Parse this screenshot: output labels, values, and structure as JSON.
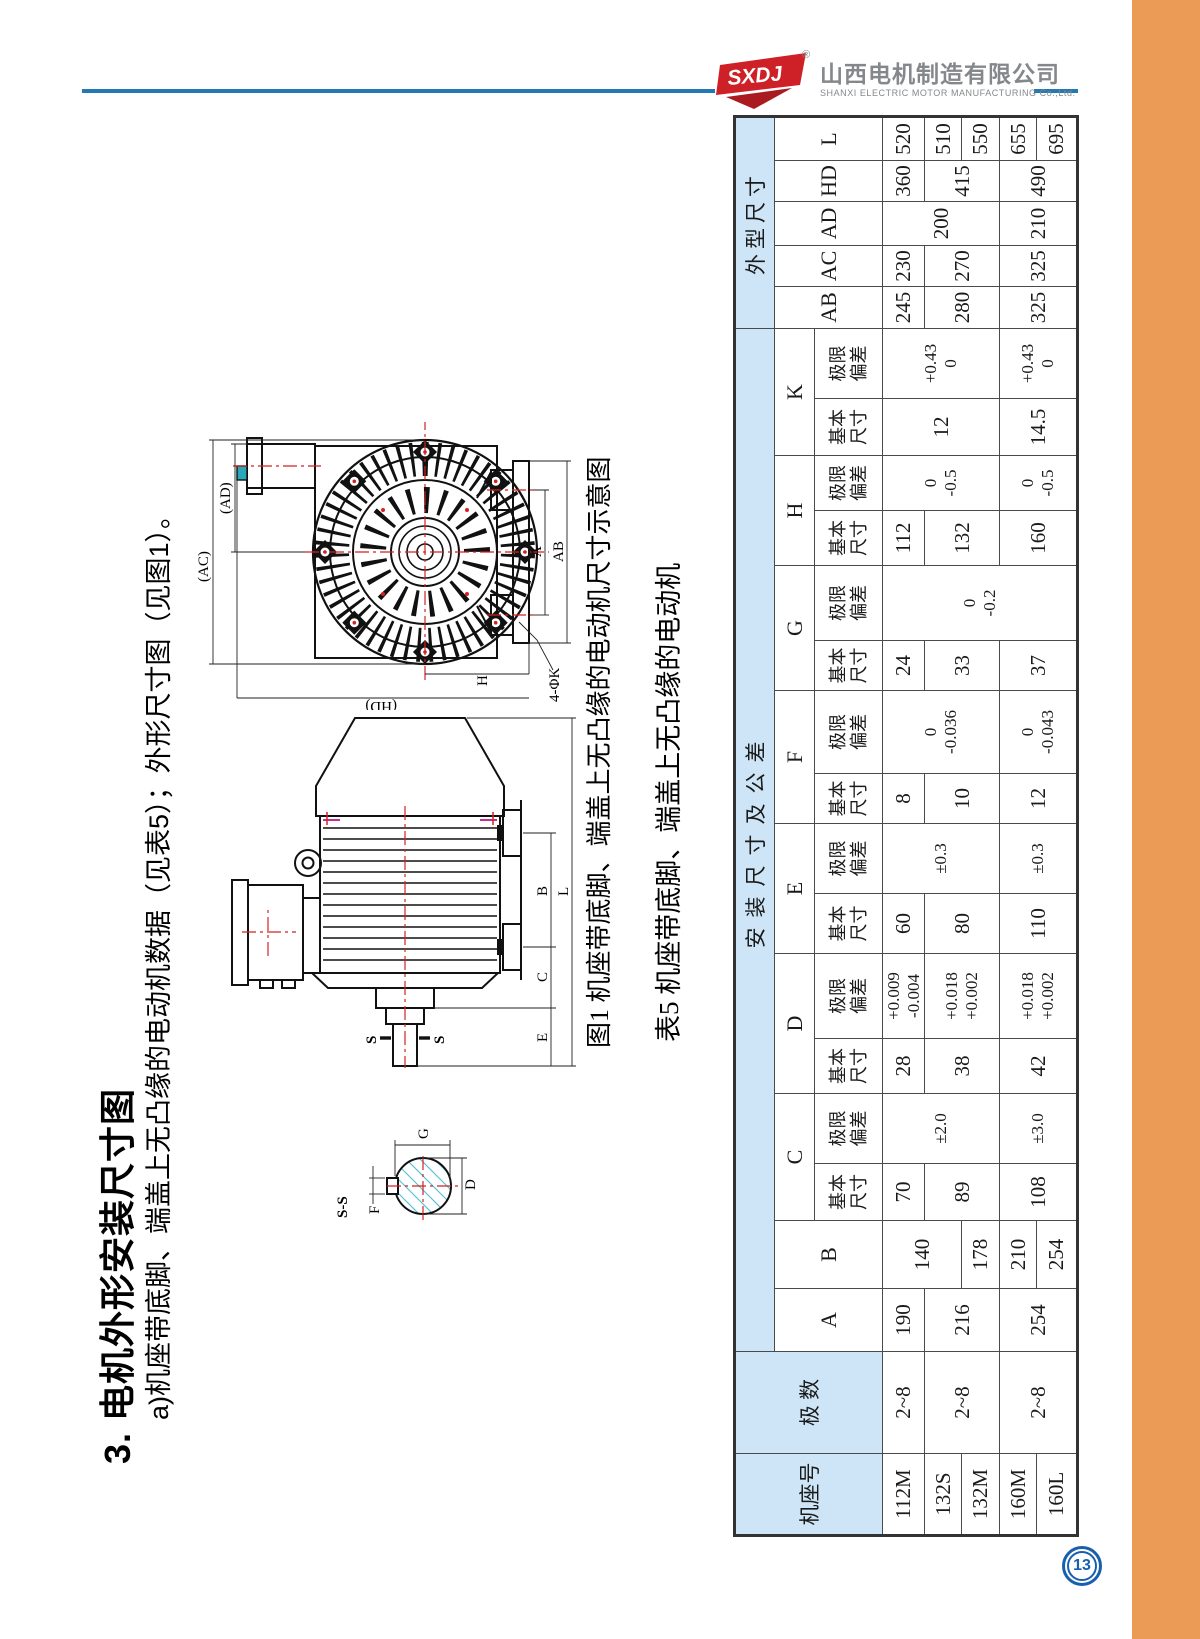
{
  "page": {
    "number": "13"
  },
  "colors": {
    "orange": "#EB9B55",
    "blue_line": "#2478B4",
    "table_header_bg": "#CDE5F6",
    "logo_red": "#CE2127",
    "logo_gray": "#85888B",
    "page_circle_blue": "#1860AE"
  },
  "header": {
    "logo_abbr": "SXDJ",
    "registered": "®",
    "company_cn": "山西电机制造有限公司",
    "company_en": "SHANXI ELECTRIC MOTOR MANUFACTURING Co.,Ltd."
  },
  "content": {
    "title": "3. 电机外形安装尺寸图",
    "subtitle": "a)机座带底脚、端盖上无凸缘的电动机数据（见表5）；外形尺寸图（见图1）。",
    "figure_caption": "图1 机座带底脚、端盖上无凸缘的电动机尺寸示意图",
    "table_caption": "表5 机座带底脚、端盖上无凸缘的电动机"
  },
  "figure": {
    "end_view": {
      "ac": "(AC)",
      "ad": "(AD)",
      "a": "A",
      "ab": "AB",
      "h": "H",
      "hd": "(HD)",
      "k4": "4-ΦK"
    },
    "side_view": {
      "s_top": "S",
      "s_bottom": "S",
      "e": "E",
      "c": "C",
      "b": "B",
      "l": "L"
    },
    "section_view": {
      "title": "S-S",
      "f": "F",
      "g": "G",
      "d": "D"
    }
  },
  "table": {
    "frame_label": "机座号",
    "poles_label": "极 数",
    "mount_group": "安装尺寸及公差",
    "outline_group": "外型尺寸",
    "sub_basic": [
      "基本",
      "尺寸"
    ],
    "sub_dev": [
      "极限",
      "偏差"
    ],
    "letters": [
      "A",
      "B",
      "C",
      "D",
      "E",
      "F",
      "G",
      "H",
      "K"
    ],
    "outline_letters": [
      "AB",
      "AC",
      "AD",
      "HD",
      "L"
    ],
    "frames": [
      "112M",
      "132S",
      "132M",
      "160M",
      "160L"
    ],
    "poles": [
      "2~8",
      "2~8",
      "2~8"
    ],
    "A": [
      "190",
      "216",
      "254"
    ],
    "B": [
      "140",
      "178",
      "210",
      "254"
    ],
    "C_basic": [
      "70",
      "89",
      "108"
    ],
    "C_dev": [
      "±2.0",
      "±3.0"
    ],
    "D_basic": [
      "28",
      "38",
      "42"
    ],
    "D_dev": [
      [
        "+0.009",
        "-0.004"
      ],
      [
        "+0.018",
        "+0.002"
      ],
      [
        "+0.018",
        "+0.002"
      ]
    ],
    "E_basic": [
      "60",
      "80",
      "110"
    ],
    "E_dev": [
      "±0.3",
      "±0.3"
    ],
    "F_basic": [
      "8",
      "10",
      "12"
    ],
    "F_dev": [
      [
        "0",
        "-0.036"
      ],
      [
        "0",
        "-0.043"
      ]
    ],
    "G_basic": [
      "24",
      "33",
      "37"
    ],
    "G_dev": [
      [
        "0",
        "-0.2"
      ]
    ],
    "H_basic": [
      "112",
      "132",
      "160"
    ],
    "H_dev": [
      [
        "0",
        "-0.5"
      ],
      [
        "0",
        "-0.5"
      ]
    ],
    "K_basic": [
      "12",
      "14.5"
    ],
    "K_dev": [
      [
        "+0.43",
        "0"
      ],
      [
        "+0.43",
        "0"
      ]
    ],
    "AB": [
      "245",
      "280",
      "325"
    ],
    "AC": [
      "230",
      "270",
      "325"
    ],
    "AD": [
      "200",
      "210"
    ],
    "HD": [
      "360",
      "415",
      "490"
    ],
    "L": [
      "520",
      "510",
      "550",
      "655",
      "695"
    ]
  }
}
